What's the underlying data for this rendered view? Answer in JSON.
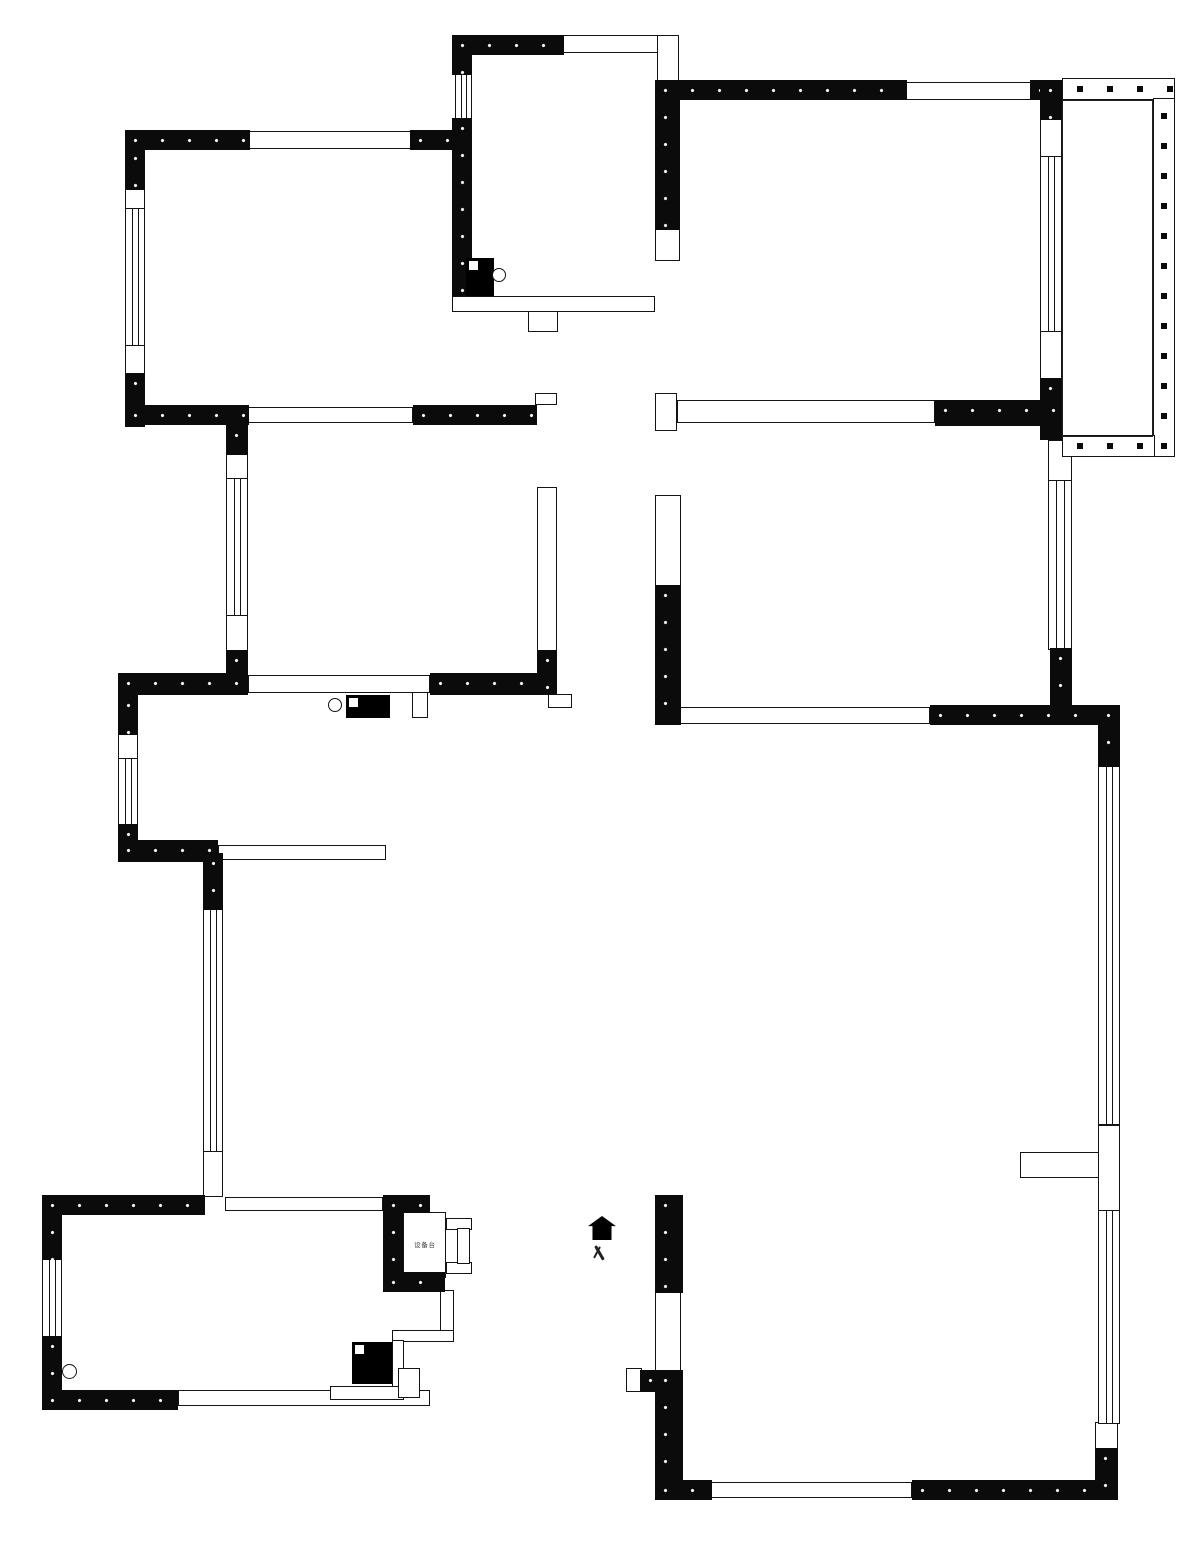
{
  "plan": {
    "canvas": {
      "width": 1200,
      "height": 1544
    },
    "colors": {
      "wall": "#0b0b0b",
      "line": "#141414",
      "background": "#ffffff"
    },
    "entrance": {
      "house": [
        588,
        1216,
        28,
        24
      ],
      "label_pos": [
        590,
        1244,
        20,
        20
      ],
      "label": "入"
    },
    "shaft": {
      "box": [
        403,
        1212,
        43,
        66
      ],
      "label": "设备台"
    },
    "walls": [
      [
        125,
        130,
        125,
        20
      ],
      [
        410,
        130,
        62,
        20
      ],
      [
        125,
        148,
        20,
        42
      ],
      [
        125,
        373,
        20,
        54
      ],
      [
        125,
        405,
        124,
        20
      ],
      [
        413,
        405,
        124,
        20
      ],
      [
        226,
        425,
        22,
        30
      ],
      [
        226,
        650,
        22,
        44
      ],
      [
        118,
        673,
        130,
        22
      ],
      [
        430,
        673,
        125,
        22
      ],
      [
        118,
        695,
        20,
        40
      ],
      [
        118,
        824,
        20,
        38
      ],
      [
        118,
        840,
        100,
        22
      ],
      [
        203,
        853,
        20,
        57
      ],
      [
        537,
        650,
        20,
        44
      ],
      [
        452,
        35,
        112,
        20
      ],
      [
        452,
        35,
        20,
        40
      ],
      [
        452,
        118,
        20,
        178
      ],
      [
        655,
        80,
        25,
        150
      ],
      [
        655,
        80,
        252,
        20
      ],
      [
        1030,
        80,
        34,
        20
      ],
      [
        1040,
        80,
        22,
        40
      ],
      [
        1040,
        378,
        22,
        62
      ],
      [
        935,
        400,
        128,
        26
      ],
      [
        655,
        585,
        26,
        140
      ],
      [
        930,
        705,
        190,
        20
      ],
      [
        1050,
        648,
        22,
        60
      ],
      [
        1098,
        705,
        22,
        62
      ],
      [
        655,
        1195,
        28,
        98
      ],
      [
        640,
        1370,
        43,
        22
      ],
      [
        655,
        1370,
        28,
        130
      ],
      [
        655,
        1480,
        57,
        20
      ],
      [
        912,
        1480,
        193,
        20
      ],
      [
        1095,
        1448,
        23,
        52
      ],
      [
        42,
        1195,
        163,
        20
      ],
      [
        42,
        1195,
        20,
        65
      ],
      [
        42,
        1336,
        20,
        74
      ],
      [
        42,
        1390,
        136,
        20
      ],
      [
        383,
        1195,
        20,
        97
      ],
      [
        383,
        1195,
        47,
        18
      ],
      [
        383,
        1272,
        62,
        20
      ]
    ],
    "openings": [
      [
        248,
        131,
        164,
        18
      ],
      [
        562,
        35,
        97,
        18
      ],
      [
        657,
        35,
        22,
        48
      ],
      [
        905,
        82,
        127,
        18
      ],
      [
        248,
        407,
        165,
        16
      ],
      [
        655,
        393,
        22,
        38
      ],
      [
        677,
        400,
        258,
        23
      ],
      [
        655,
        225,
        25,
        36
      ],
      [
        248,
        675,
        182,
        18
      ],
      [
        537,
        487,
        20,
        165
      ],
      [
        655,
        495,
        26,
        92
      ],
      [
        680,
        707,
        250,
        17
      ],
      [
        218,
        845,
        168,
        15
      ],
      [
        178,
        1390,
        252,
        16
      ],
      [
        225,
        1197,
        158,
        14
      ],
      [
        710,
        1482,
        202,
        16
      ],
      [
        655,
        1290,
        26,
        82
      ],
      [
        626,
        1368,
        16,
        24
      ],
      [
        1020,
        1152,
        80,
        26
      ],
      [
        1040,
        118,
        22,
        40
      ],
      [
        1040,
        330,
        22,
        50
      ],
      [
        1048,
        440,
        24,
        42
      ],
      [
        1098,
        1125,
        22,
        87
      ],
      [
        1095,
        1422,
        23,
        28
      ],
      [
        125,
        186,
        20,
        24
      ],
      [
        125,
        344,
        20,
        31
      ],
      [
        226,
        453,
        22,
        27
      ],
      [
        226,
        614,
        22,
        38
      ],
      [
        118,
        733,
        20,
        27
      ],
      [
        203,
        1150,
        20,
        47
      ],
      [
        535,
        393,
        22,
        12
      ],
      [
        412,
        692,
        16,
        26
      ],
      [
        548,
        694,
        24,
        14
      ],
      [
        528,
        296,
        30,
        36
      ],
      [
        452,
        296,
        203,
        16
      ],
      [
        440,
        1290,
        14,
        46
      ],
      [
        392,
        1330,
        62,
        12
      ],
      [
        392,
        1340,
        12,
        52
      ],
      [
        330,
        1386,
        74,
        14
      ],
      [
        398,
        1368,
        22,
        30
      ],
      [
        446,
        1218,
        26,
        12
      ],
      [
        446,
        1262,
        26,
        12
      ],
      [
        457,
        1228,
        13,
        36
      ]
    ],
    "windows": [
      [
        125,
        208,
        20,
        138
      ],
      [
        226,
        478,
        22,
        138
      ],
      [
        455,
        73,
        17,
        47
      ],
      [
        118,
        758,
        20,
        68
      ],
      [
        203,
        908,
        20,
        244
      ],
      [
        42,
        1258,
        20,
        80
      ],
      [
        1040,
        156,
        22,
        176
      ],
      [
        1048,
        480,
        24,
        170
      ],
      [
        1098,
        765,
        22,
        360
      ],
      [
        1098,
        1210,
        22,
        214
      ]
    ],
    "railings": [
      [
        1062,
        78,
        113,
        22
      ],
      [
        1153,
        98,
        22,
        359
      ],
      [
        1062,
        435,
        93,
        22
      ]
    ],
    "inner_lines": [
      [
        1062,
        100,
        91,
        337
      ]
    ],
    "columns": [
      [
        466,
        258,
        28,
        38
      ],
      [
        346,
        695,
        44,
        23
      ],
      [
        352,
        1342,
        40,
        42
      ]
    ],
    "circles": [
      [
        492,
        268,
        14
      ],
      [
        328,
        698,
        14
      ],
      [
        62,
        1364,
        15
      ]
    ]
  }
}
